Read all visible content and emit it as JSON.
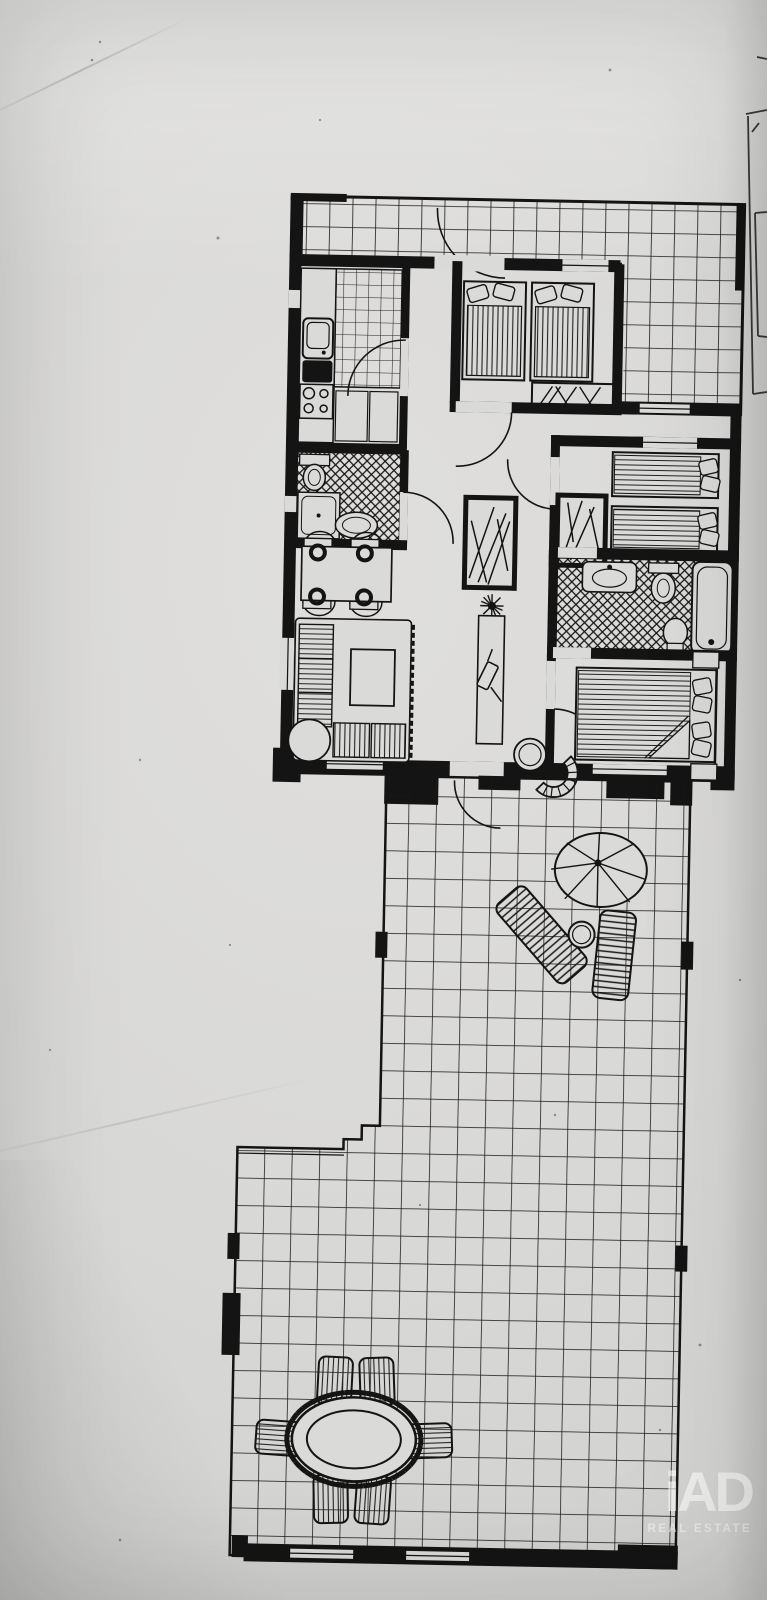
{
  "watermark": {
    "brand": "iAD",
    "tagline": "REAL ESTATE",
    "text_color": "#ffffff"
  },
  "palette": {
    "paper": "#d9d8d6",
    "ink": "#141414"
  },
  "floor_plan": {
    "areas": [
      "upper-terrace",
      "kitchen",
      "bathroom-1",
      "bedroom-1",
      "hallway",
      "dining-area",
      "living-room",
      "bedroom-2",
      "bathroom-2",
      "bedroom-3",
      "main-terrace",
      "lower-terrace"
    ],
    "fixtures": {
      "kitchen": [
        "sink",
        "stove-4-burners",
        "counter",
        "cabinets",
        "tiled-floor"
      ],
      "bathroom_1": [
        "toilet",
        "shower",
        "washbasin"
      ],
      "bedroom_1": [
        "twin-bed",
        "twin-bed",
        "wardrobe-with-hangers"
      ],
      "bedroom_2": [
        "twin-bed",
        "twin-bed",
        "wardrobe-with-hangers"
      ],
      "bathroom_2": [
        "washbasin",
        "toilet",
        "bidet",
        "bathtub"
      ],
      "bedroom_3": [
        "double-bed",
        "nightstand",
        "nightstand",
        "fan-armchair"
      ],
      "living_room": [
        "corner-sofa",
        "coffee-table",
        "round-side-table"
      ],
      "dining_area": [
        "table",
        "chair",
        "chair",
        "chair",
        "chair"
      ],
      "hallway": [
        "closet-with-hangers",
        "console",
        "plant",
        "round-table"
      ],
      "main_terrace": [
        "parasol",
        "sun-lounger",
        "sun-lounger",
        "side-table"
      ],
      "lower_terrace": [
        "oval-dining-table",
        "chair",
        "chair",
        "chair",
        "chair",
        "chair",
        "chair"
      ]
    }
  }
}
